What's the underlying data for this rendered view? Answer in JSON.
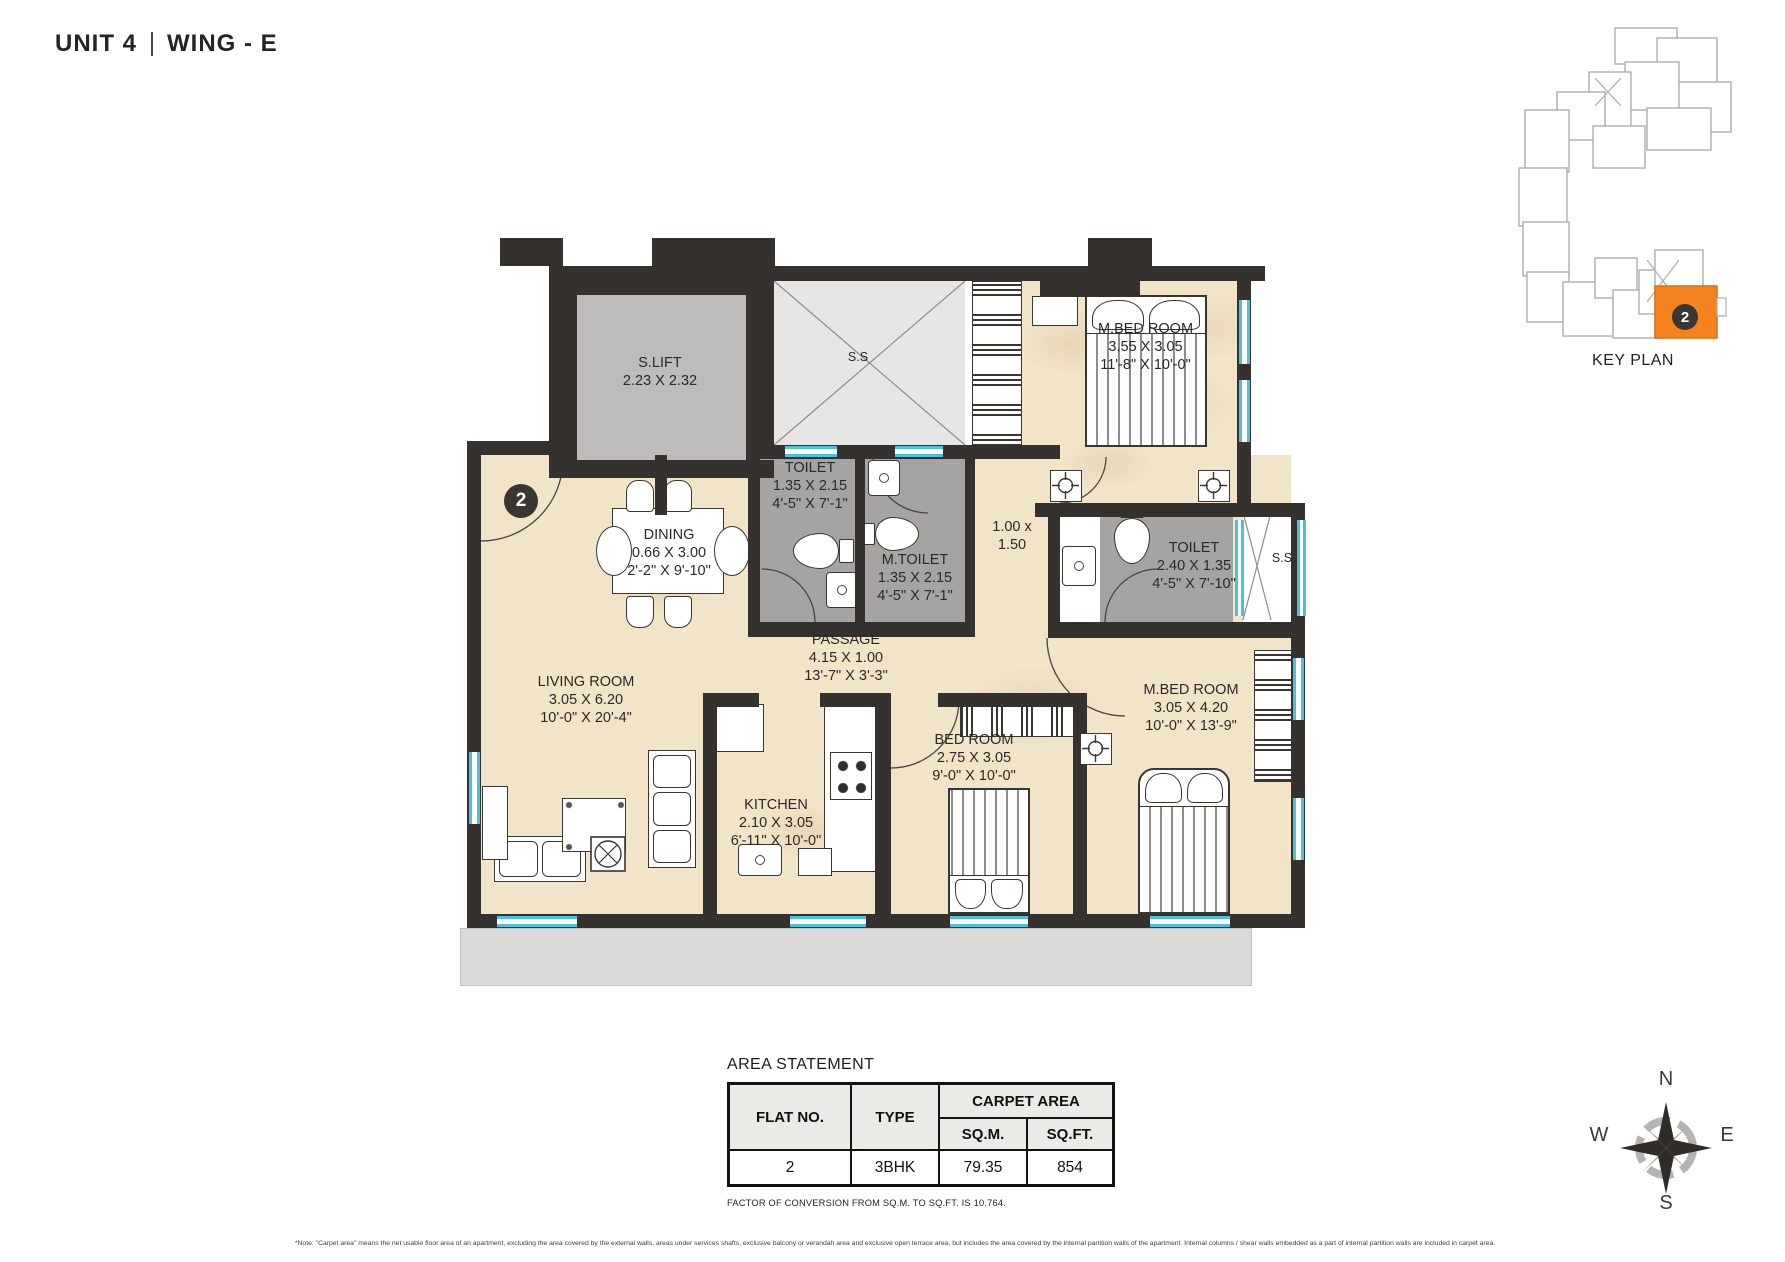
{
  "header": {
    "unit_label": "UNIT 4",
    "wing_label": "WING - E"
  },
  "key_plan": {
    "title": "KEY PLAN",
    "unit_badge": "2",
    "highlight_color": "#F58220"
  },
  "floor_plan": {
    "entry_badge": "2",
    "rooms": {
      "slift": {
        "name": "S.LIFT",
        "dim_m": "2.23 X 2.32"
      },
      "staircase": {
        "name": "S.S"
      },
      "mbed1": {
        "name": "M.BED ROOM",
        "dim_m": "3.55 X 3.05",
        "dim_ft": "11'-8\" X 10'-0\""
      },
      "toilet1": {
        "name": "TOILET",
        "dim_m": "1.35 X 2.15",
        "dim_ft": "4'-5\" X 7'-1\""
      },
      "mtoilet": {
        "name": "M.TOILET",
        "dim_m": "1.35 X 2.15",
        "dim_ft": "4'-5\" X 7'-1\""
      },
      "lobby": {
        "dim_line1": "1.00 x",
        "dim_line2": "1.50"
      },
      "toilet2": {
        "name": "TOILET",
        "dim_m": "2.40 X 1.35",
        "dim_ft": "4'-5\" X 7'-10\""
      },
      "ss_shaft": {
        "name": "S.S"
      },
      "dining": {
        "name": "DINING",
        "dim_m": "0.66 X 3.00",
        "dim_ft": "2'-2\" X 9'-10\""
      },
      "passage": {
        "name": "PASSAGE",
        "dim_m": "4.15 X 1.00",
        "dim_ft": "13'-7\" X 3'-3\""
      },
      "living": {
        "name": "LIVING ROOM",
        "dim_m": "3.05 X 6.20",
        "dim_ft": "10'-0\" X 20'-4\""
      },
      "kitchen": {
        "name": "KITCHEN",
        "dim_m": "2.10 X 3.05",
        "dim_ft": "6'-11\" X 10'-0\""
      },
      "bed2": {
        "name": "BED ROOM",
        "dim_m": "2.75 X 3.05",
        "dim_ft": "9'-0\" X 10'-0\""
      },
      "mbed2": {
        "name": "M.BED ROOM",
        "dim_m": "3.05 X 4.20",
        "dim_ft": "10'-0\" X 13'-9\""
      }
    }
  },
  "area_statement": {
    "title": "AREA STATEMENT",
    "col_flat": "FLAT NO.",
    "col_type": "TYPE",
    "col_carpet": "CARPET AREA",
    "col_sqm": "SQ.M.",
    "col_sqft": "SQ.FT.",
    "row": {
      "flat": "2",
      "type": "3BHK",
      "sqm": "79.35",
      "sqft": "854"
    },
    "conversion_note": "FACTOR OF CONVERSION FROM SQ.M. TO SQ.FT. IS 10.764."
  },
  "compass": {
    "north": "N",
    "east": "E",
    "south": "S",
    "west": "W"
  },
  "footnote": "*Note: \"Carpet area\" means the net usable floor area of an apartment, excluding the area covered by the external walls, areas under services shafts, exclusive balcony or verandah area and exclusive open terrace area, but includes the area covered by the internal partition walls of the apartment. Internal columns / shear walls embedded as a part of internal partition walls are included in carpet area."
}
